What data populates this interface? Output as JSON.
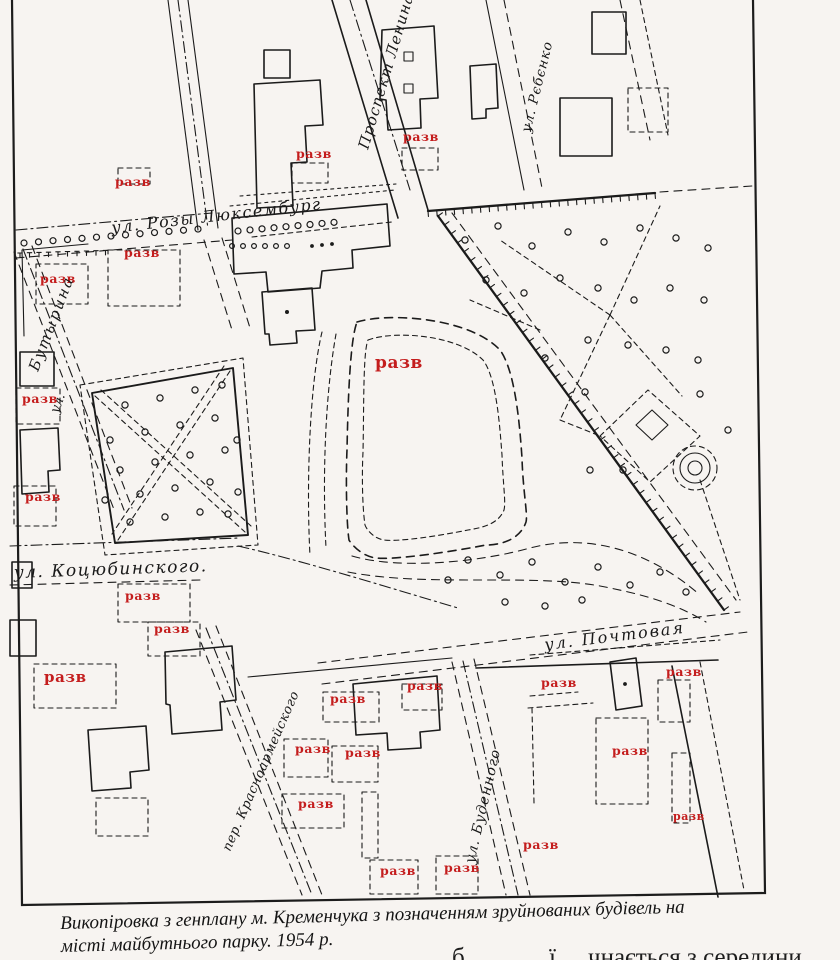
{
  "map": {
    "ink_color": "#1b1b1b",
    "razv_color": "#c41d1d",
    "labels": {
      "razv": "разв"
    },
    "streets": {
      "rozy_luxemburg": "ул. Розы Люксембург",
      "kotsubinskogo": "ул. Коцюбинского.",
      "pochtovaya": "ул. Почтовая",
      "prospekt_lenina": "Проспект Ленина",
      "rebenko": "ул. Рєбєнко",
      "budennogo": "ул. Буденного",
      "butyrina_name": "Бутырина",
      "butyrina_prefix": "ул.",
      "pereulok": "пер. Красноармейского"
    }
  },
  "caption": {
    "line1": "Викопіровка з генплану м. Кременчука з позначенням зруйнованих будівель на",
    "line2": "місті майбутнього парку. 1954 р."
  },
  "cutoff": {
    "frag1": "б",
    "frag2": "ї",
    "frag3": "чнається з середини"
  }
}
